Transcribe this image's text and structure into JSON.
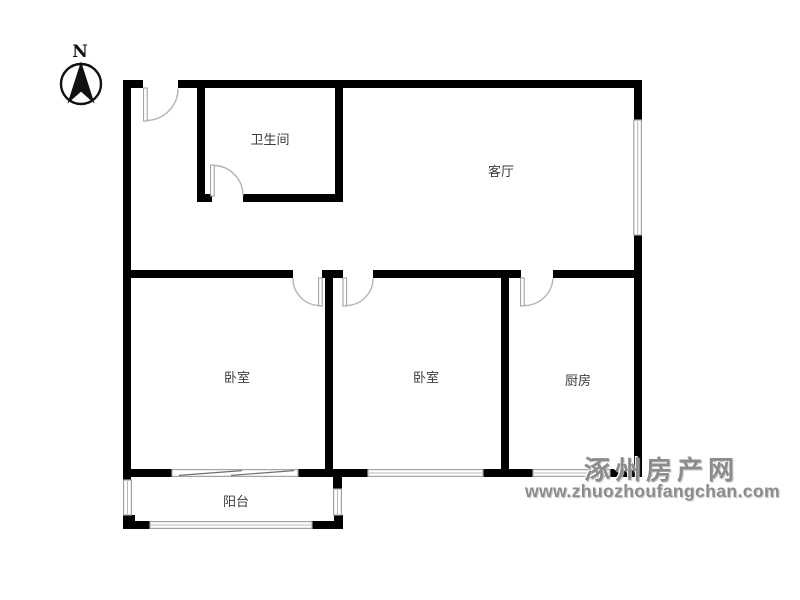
{
  "compass": {
    "label": "N"
  },
  "rooms": {
    "bathroom": {
      "label": "卫生间"
    },
    "living_room": {
      "label": "客厅"
    },
    "bedroom_left": {
      "label": "卧室"
    },
    "bedroom_middle": {
      "label": "卧室"
    },
    "kitchen": {
      "label": "厨房"
    },
    "balcony": {
      "label": "阳台"
    }
  },
  "watermark": {
    "site_name": "涿州房产网",
    "site_url": "www.zhuozhoufangchan.com"
  },
  "colors": {
    "background": "#ffffff",
    "wall": "#000000",
    "window": "#a3a3a3",
    "door_arc": "#b3b3b3",
    "label_text": "#3c3c3c",
    "watermark": "#8c8c8c"
  }
}
